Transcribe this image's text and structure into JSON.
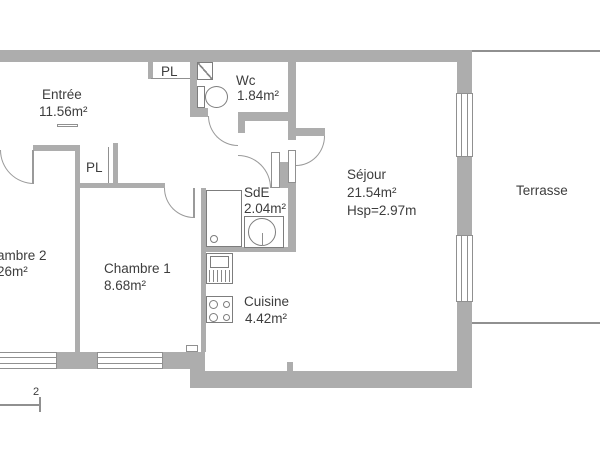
{
  "plan": {
    "rooms": {
      "entree": {
        "label": "Entrée",
        "area": "11.56m²"
      },
      "wc": {
        "label": "Wc",
        "area": "1.84m²"
      },
      "sejour": {
        "label": "Séjour",
        "area": "21.54m²",
        "ceiling_height": "Hsp=2.97m"
      },
      "terrasse": {
        "label": "Terrasse"
      },
      "chambre2": {
        "label": "ambre 2",
        "area": "26m²"
      },
      "chambre1": {
        "label": "Chambre 1",
        "area": "8.68m²"
      },
      "sde": {
        "label": "SdE",
        "area": "2.04m²"
      },
      "cuisine": {
        "label": "Cuisine",
        "area": "4.42m²"
      }
    },
    "closets": {
      "pl_top": "PL",
      "pl_hall": "PL"
    },
    "scale_marker": {
      "value": "2"
    },
    "colors": {
      "wall": "#adadad",
      "line": "#909090",
      "fixture": "#7d7d7d",
      "text": "#3d3d3d",
      "background": "#ffffff"
    }
  }
}
